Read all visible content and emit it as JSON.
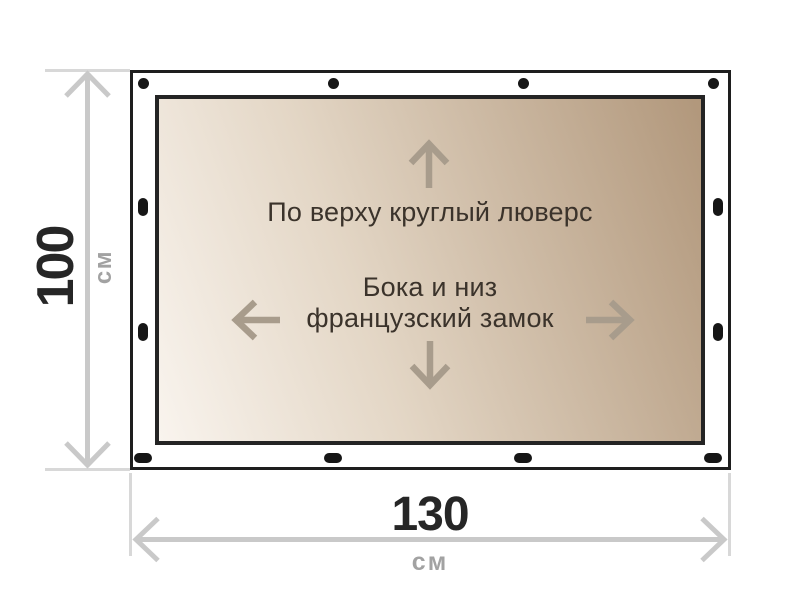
{
  "diagram": {
    "fabric_annotations": {
      "top_edge": "По верху круглый люверс",
      "sides_line1": "Бока и низ",
      "sides_line2": "французский замок"
    },
    "dimensions": {
      "height": {
        "value": "100",
        "unit": "см"
      },
      "width": {
        "value": "130",
        "unit": "см"
      }
    },
    "fasteners": {
      "top_grommets": 4,
      "bottom_locks": 4,
      "left_locks": 2,
      "right_locks": 2
    },
    "icons": {
      "up_arrow": "↑",
      "down_arrow": "↓",
      "left_arrow": "←",
      "right_arrow": "→",
      "grommet": "filled-circle",
      "lock_slot": "filled-oval"
    },
    "colors": {
      "fabric_gradient_light": "#f9f4ee",
      "fabric_gradient_dark": "#b1977b",
      "outline_black": "#1e1e1e",
      "dimension_line_gray": "#c9c9c9",
      "extension_line_gray": "#d8d8d8",
      "value_text_dark": "#262626",
      "unit_text_gray": "#a2a2a2",
      "annotation_text": "#3b332b",
      "fabric_arrow_brown": "#a89c8c"
    }
  }
}
